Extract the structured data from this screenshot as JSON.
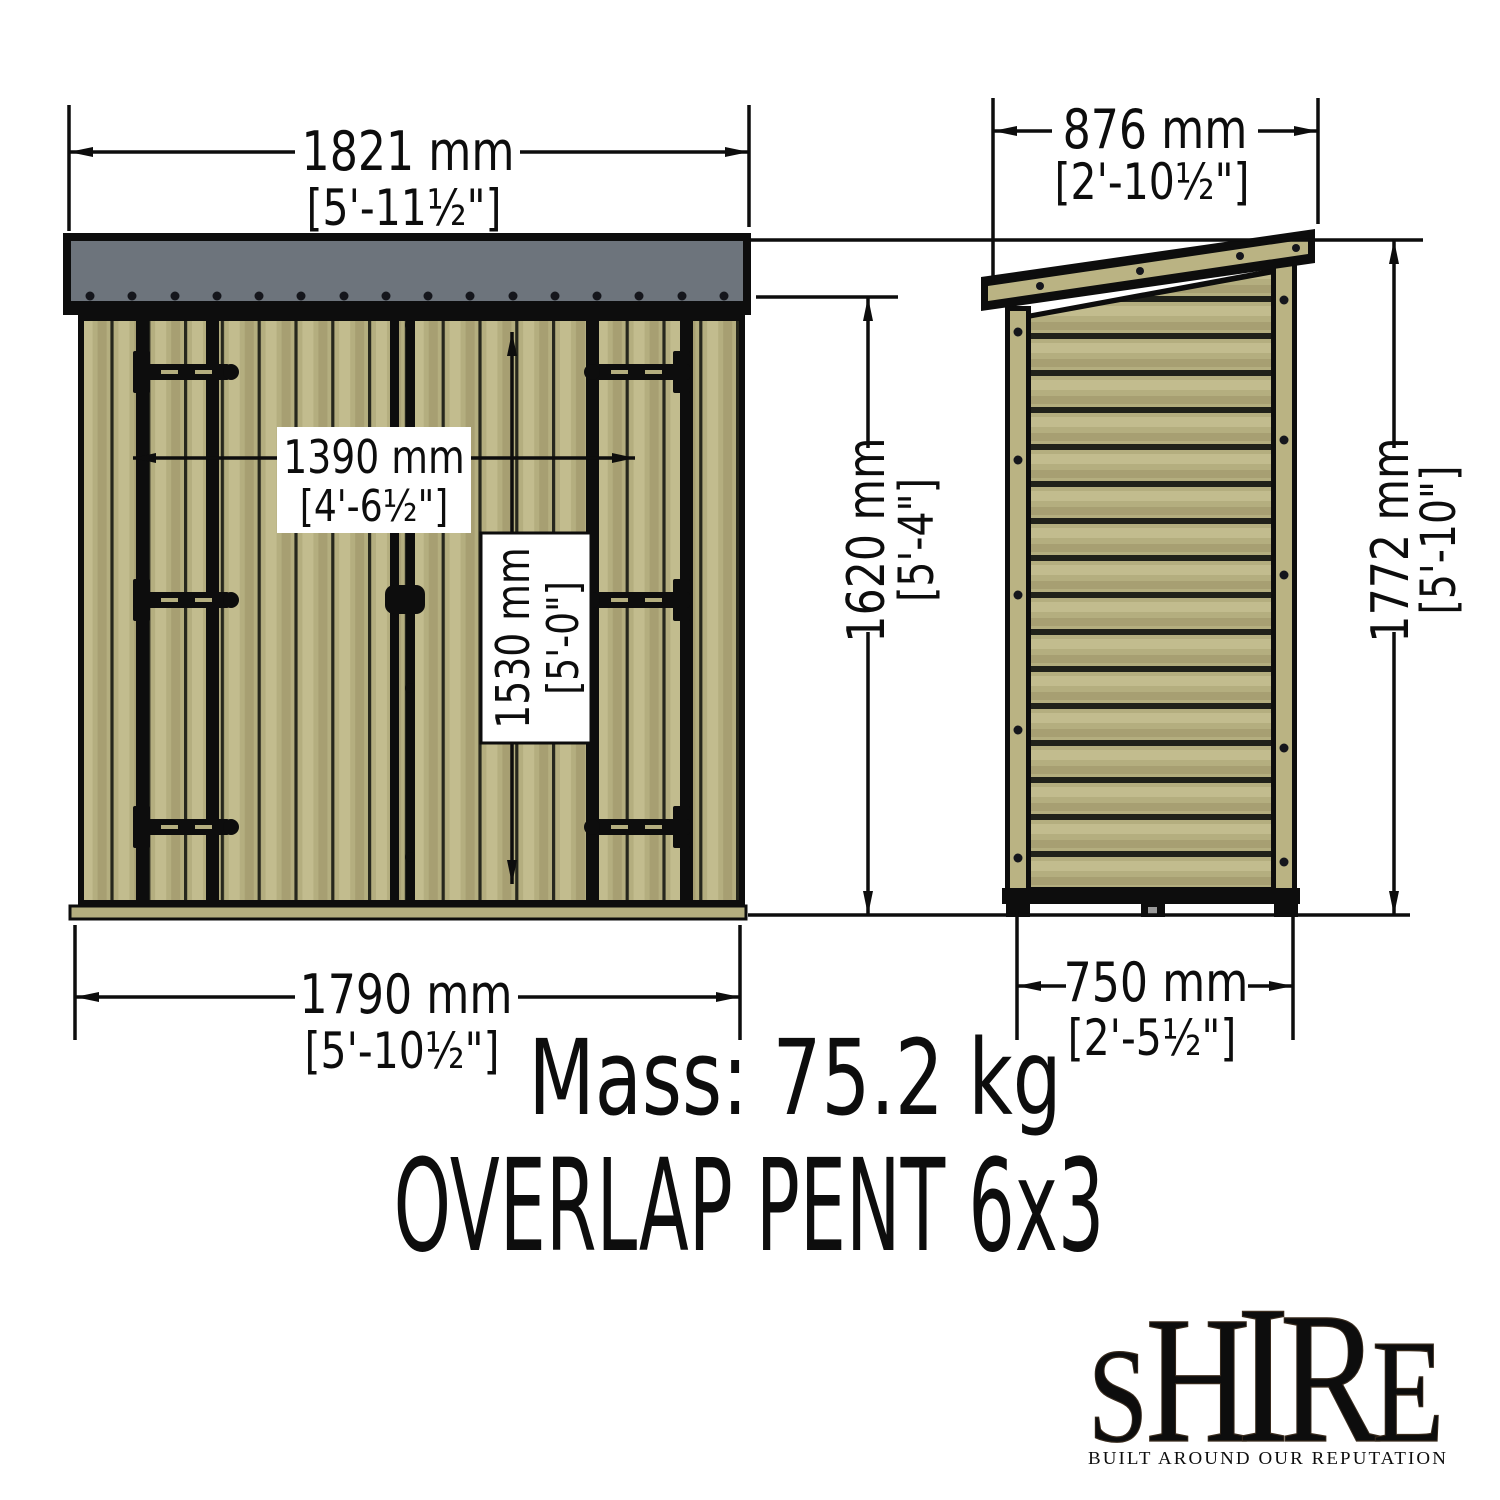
{
  "colors": {
    "wood": "#b4ae7f",
    "wood_light": "#c2bc8e",
    "wood_dark": "#a79f72",
    "roof_gray": "#6d747c",
    "line_black": "#0d0d0d",
    "label_bg": "#ffffff",
    "logo_navy": "#2b2b5e",
    "logo_silver": "#d8d9e2",
    "logo_copper": "#a06038",
    "logo_tagline_gray": "#83838d"
  },
  "views": {
    "front": {
      "overall_width": {
        "mm": "1821 mm",
        "imperial": "[5'-11½\"]"
      },
      "base_width": {
        "mm": "1790 mm",
        "imperial": "[5'-10½\"]"
      },
      "door_width": {
        "mm": "1390 mm",
        "imperial": "[4'-6½\"]"
      },
      "door_height": {
        "mm": "1530 mm",
        "imperial": "[5'-0\"]"
      },
      "eaves_height": {
        "mm": "1620 mm",
        "imperial": "[5'-4\"]"
      }
    },
    "side": {
      "overall_depth": {
        "mm": "876 mm",
        "imperial": "[2'-10½\"]"
      },
      "base_depth": {
        "mm": "750 mm",
        "imperial": "[2'-5½\"]"
      },
      "overall_height": {
        "mm": "1772 mm",
        "imperial": "[5'-10\"]"
      }
    }
  },
  "mass_label": "Mass: 75.2 kg",
  "product_title": "OVERLAP PENT 6x3",
  "logo": {
    "letters": [
      "S",
      "H",
      "I",
      "R",
      "E"
    ],
    "tagline": "BUILT AROUND OUR REPUTATION"
  }
}
